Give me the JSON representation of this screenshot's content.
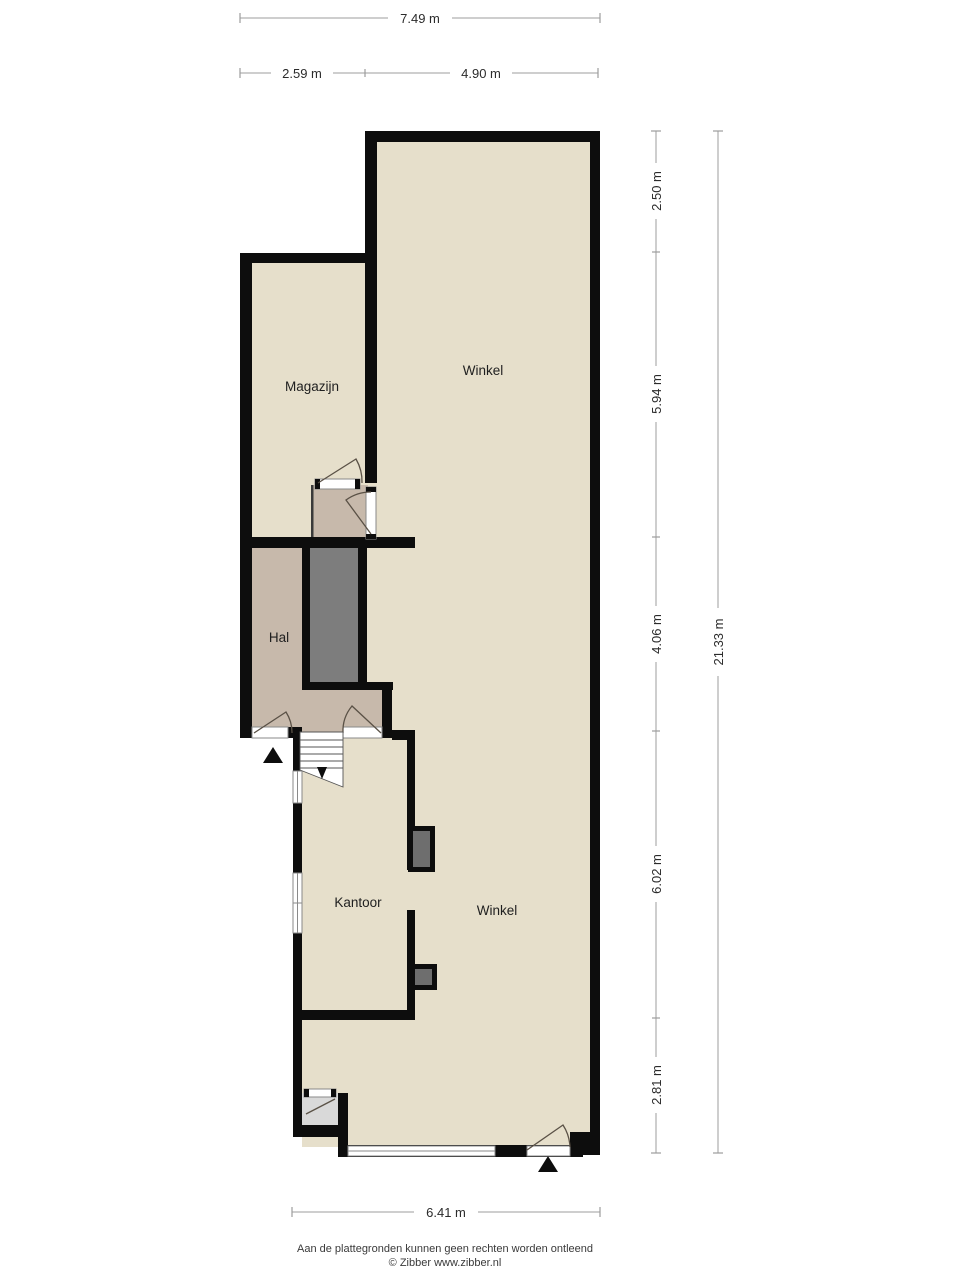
{
  "rooms": {
    "magazijn": {
      "label": "Magazijn"
    },
    "winkel_top": {
      "label": "Winkel"
    },
    "hal": {
      "label": "Hal"
    },
    "kantoor": {
      "label": "Kantoor"
    },
    "winkel_bottom": {
      "label": "Winkel"
    }
  },
  "dims": {
    "top_total": "7.49 m",
    "top_left": "2.59 m",
    "top_right": "4.90 m",
    "right_1": "2.50 m",
    "right_2": "5.94 m",
    "right_3": "4.06 m",
    "right_4": "6.02 m",
    "right_5": "2.81 m",
    "right_total": "21.33 m",
    "bottom": "6.41 m"
  },
  "footer": {
    "line1": "Aan de plattegronden kunnen geen rechten worden ontleend",
    "line2": "© Zibber www.zibber.nl"
  },
  "colors": {
    "room_beige": "#e6dfcb",
    "room_tan": "#c7b9ab",
    "stair_shaft_gray": "#7d7d7d",
    "pillar_gray": "#6e6e6e",
    "entry_gray": "#d9d9d9",
    "wall_black": "#0d0d0d",
    "dim_gray": "#9c9c9c",
    "white": "#ffffff"
  }
}
